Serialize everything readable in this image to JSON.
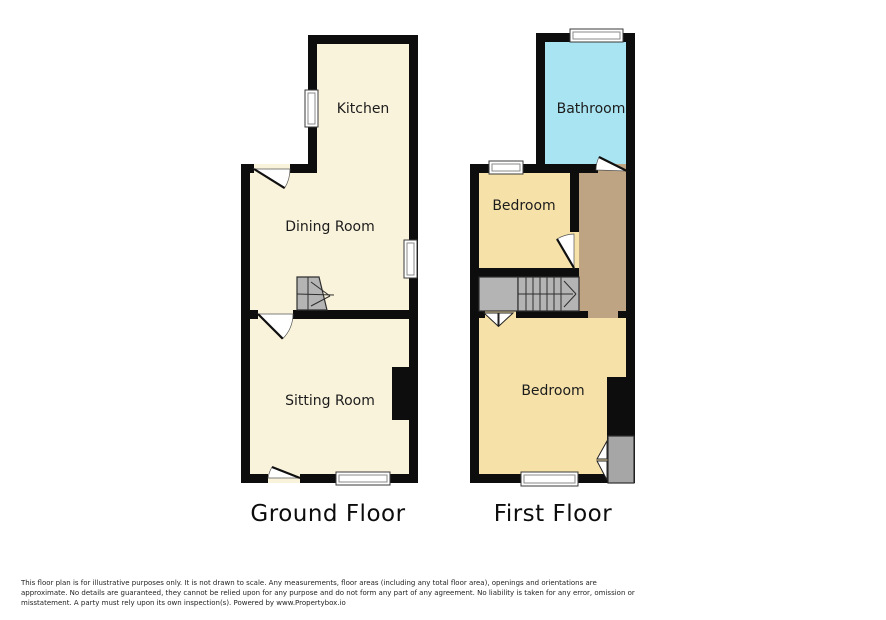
{
  "colors": {
    "wall": "#0d0d0d",
    "ground_room": "#faf3dc",
    "bedroom_yellow": "#f6e2a9",
    "bathroom_cyan": "#a9e4f2",
    "landing_tan": "#bfa483",
    "stair_gray": "#b4b4b4",
    "wardrobe_gray": "#a6a6a6",
    "window_white": "#ffffff"
  },
  "plans": {
    "ground": {
      "title": "Ground Floor",
      "kitchen": "Kitchen",
      "dining_room": "Dining Room",
      "sitting_room": "Sitting Room"
    },
    "first": {
      "title": "First Floor",
      "bathroom": "Bathroom",
      "bedroom_front": "Bedroom",
      "bedroom_back": "Bedroom"
    }
  },
  "disclaimer": {
    "line1": "This floor plan is for illustrative purposes only. It is not drawn to scale. Any measurements, floor areas (including any total floor area), openings and orientations are",
    "line2": "approximate. No details are guaranteed, they cannot be relied upon for any purpose and do not form any part of any agreement. No liability is taken for any error, omission or",
    "line3": "misstatement. A party must rely upon its own inspection(s). Powered by www.Propertybox.io"
  }
}
